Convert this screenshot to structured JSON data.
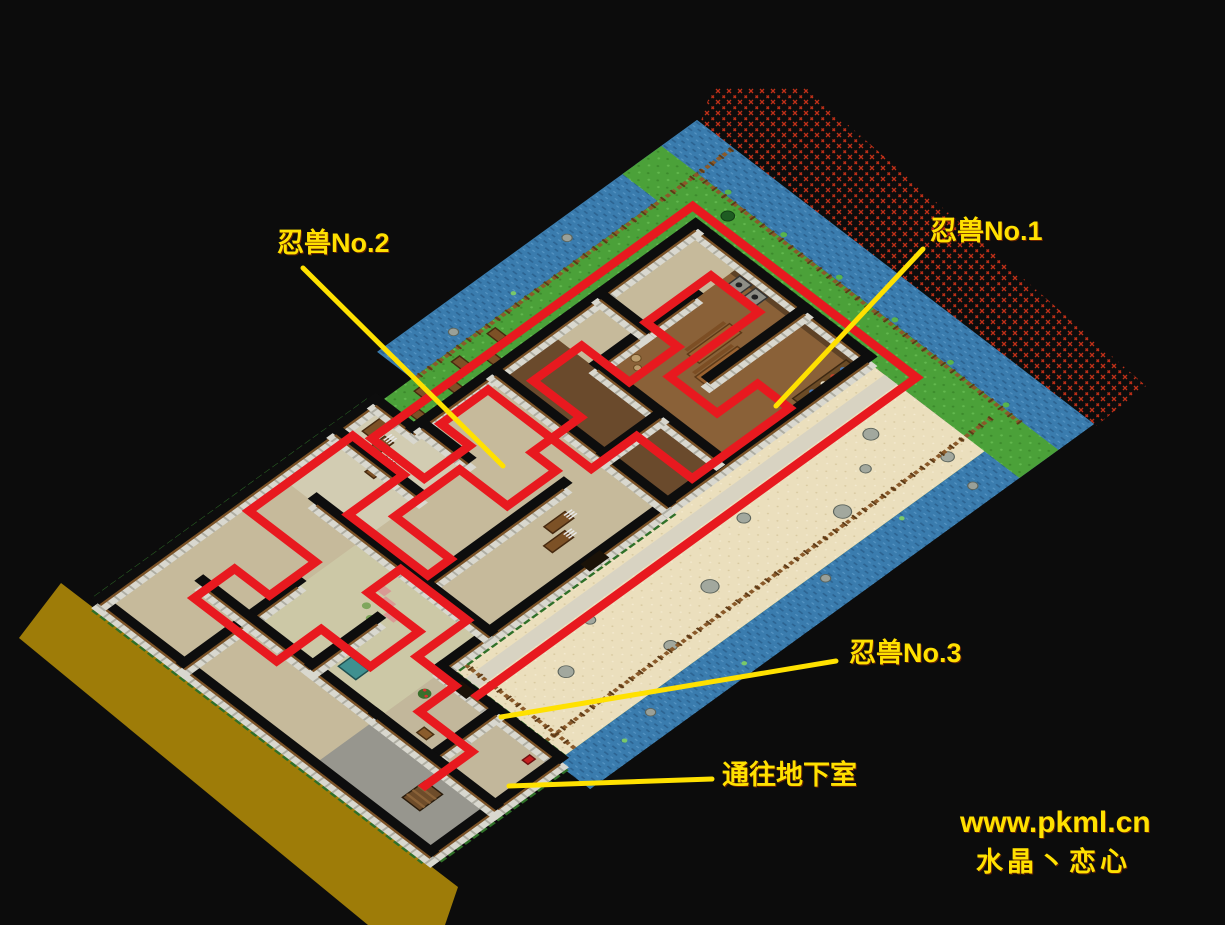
{
  "annotations": [
    {
      "id": "ninja-beast-2",
      "text": "忍兽No.2"
    },
    {
      "id": "ninja-beast-1",
      "text": "忍兽No.1"
    },
    {
      "id": "ninja-beast-3",
      "text": "忍兽No.3"
    },
    {
      "id": "basement-entrance",
      "text": "通往地下室"
    }
  ],
  "watermark": {
    "site": "www.pkml.cn",
    "credit": "水晶丶恋心"
  },
  "colors": {
    "annotation": "#ffe100",
    "route": "#e8191f",
    "water": "#3a7cae",
    "grass": "#4ba139",
    "sand": "#ebdfbd",
    "road": "#9e7c08",
    "hatch": "#c03018",
    "wall_face": "#d9d8cf",
    "wall_top": "#0d0d0d",
    "background": "#0c0c0c"
  }
}
